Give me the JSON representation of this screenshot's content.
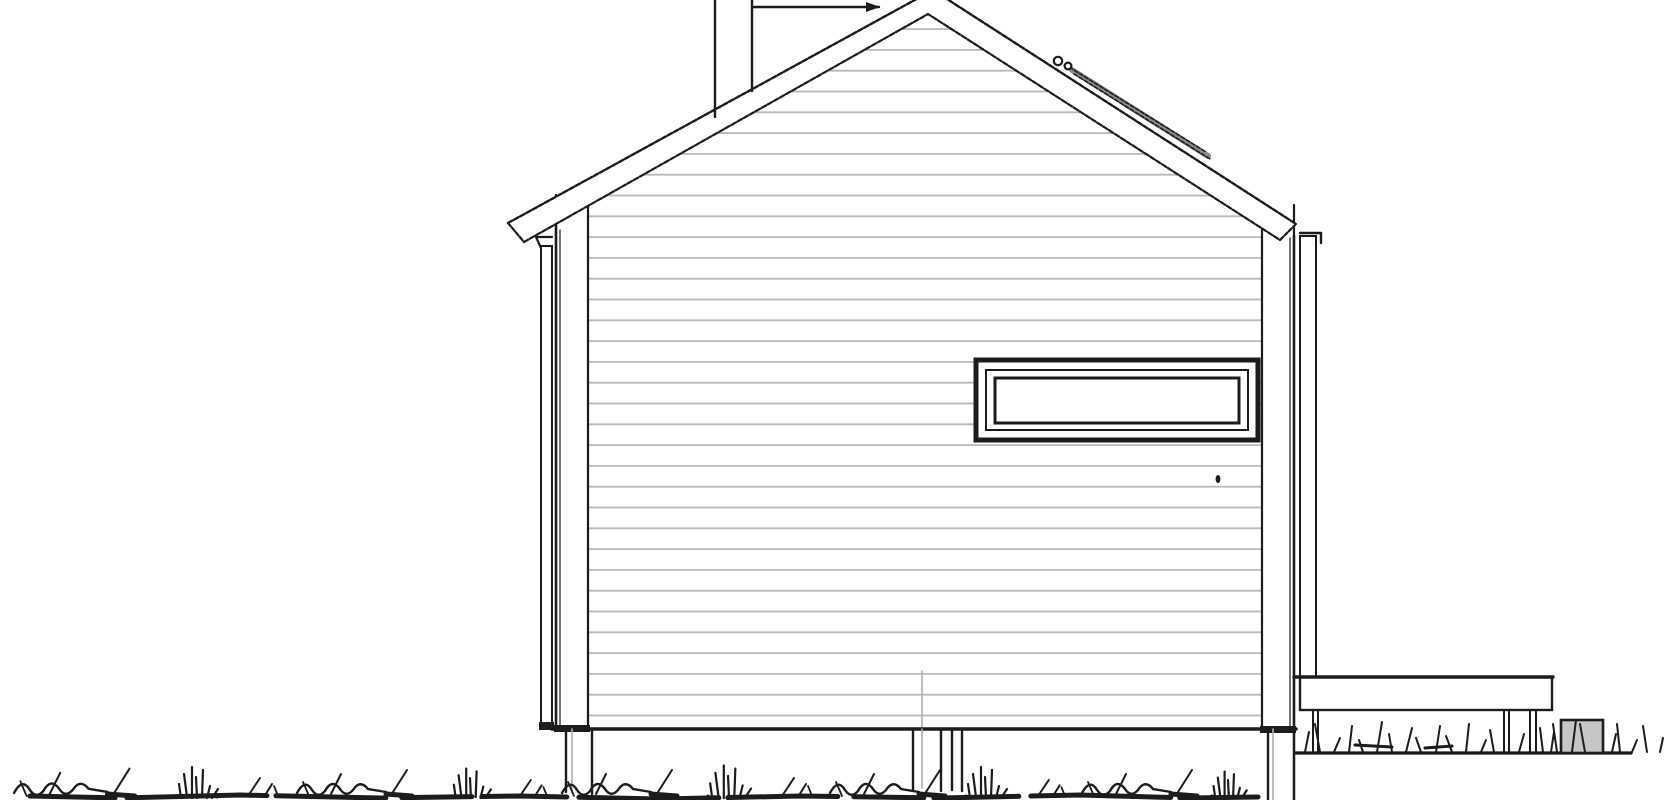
{
  "canvas": {
    "width": 1670,
    "height": 800,
    "background": "#ffffff"
  },
  "palette": {
    "ink": "#1c1c1c",
    "siding_line": "#b9b9b9",
    "faint_line": "#adadad",
    "accessory_gray": "#8a8a8a",
    "utility_fill": "#c6c6c6",
    "paper": "#ffffff"
  },
  "elevation": {
    "roof": {
      "band": [
        [
          508,
          223
        ],
        [
          933,
          -10
        ],
        [
          1296,
          224
        ],
        [
          1280,
          240
        ],
        [
          928,
          14
        ],
        [
          524,
          242
        ]
      ],
      "outer": [
        [
          508,
          223
        ],
        [
          933,
          -10
        ],
        [
          1296,
          224
        ]
      ],
      "inner": [
        [
          524,
          242
        ],
        [
          928,
          14
        ],
        [
          1280,
          240
        ]
      ],
      "caps": [
        [
          [
            508,
            223
          ],
          [
            524,
            242
          ]
        ],
        [
          [
            1296,
            224
          ],
          [
            1280,
            240
          ]
        ]
      ],
      "accessory": {
        "x1": 1072,
        "y1": 70,
        "x2": 1208,
        "y2": 156,
        "rings": [
          [
            1058,
            61,
            4.2
          ],
          [
            1068,
            66,
            3.4
          ]
        ]
      }
    },
    "chimney": {
      "lines": [
        [
          715,
          0,
          715,
          117
        ],
        [
          752,
          0,
          752,
          91
        ],
        [
          753,
          7,
          879,
          7
        ]
      ],
      "arrow": [
        [
          866,
          2
        ],
        [
          880,
          7
        ],
        [
          866,
          12
        ]
      ]
    },
    "facade": {
      "outline": [
        [
          556,
          224
        ],
        [
          928,
          14
        ],
        [
          1294,
          238
        ],
        [
          1294,
          729
        ],
        [
          556,
          729
        ]
      ],
      "left_edge": [
        556,
        226,
        556,
        729
      ],
      "right_edge": [
        1294,
        236,
        1294,
        800
      ],
      "edge_double_lines": [
        [
          560,
          230,
          560,
          728
        ],
        [
          1290,
          238,
          1290,
          728
        ]
      ],
      "bottom_line": [
        552,
        729,
        1296,
        729
      ],
      "siding_clip": [
        [
          588,
          206
        ],
        [
          928,
          14
        ],
        [
          1262,
          214
        ],
        [
          1262,
          729
        ],
        [
          588,
          729
        ]
      ],
      "siding": {
        "x1": 588,
        "x2": 1262,
        "bottom": 715.5,
        "spacing": 20.8,
        "count": 34
      },
      "corner_trims": [
        {
          "x": 556,
          "w": 32,
          "top": 195
        },
        {
          "x": 1262,
          "w": 32,
          "top": 205
        }
      ],
      "trim_caps": [
        [
          554,
          725,
          36,
          7
        ],
        [
          1260,
          726,
          36,
          7
        ]
      ],
      "center_joint": {
        "x": 922,
        "y1": 671,
        "y2": 729
      },
      "handle_dot": {
        "x": 1218,
        "y": 479
      }
    },
    "window": {
      "outer": [
        976,
        360,
        282,
        80
      ],
      "mid": [
        986,
        370,
        262,
        60
      ],
      "glass": [
        995,
        378,
        244,
        45
      ]
    },
    "downspouts": {
      "left": {
        "rect": [
          541,
          246,
          11,
          481
        ],
        "cap": [
          539,
          722,
          15,
          8
        ],
        "hook": [
          [
            552,
            237
          ],
          [
            536,
            237
          ],
          [
            541,
            248
          ]
        ]
      },
      "right": {
        "rect": [
          1300,
          236,
          16,
          441
        ],
        "hook": [
          [
            1300,
            233
          ],
          [
            1321,
            233
          ],
          [
            1321,
            243
          ]
        ]
      }
    },
    "foundation": {
      "posts": [
        {
          "black": [
            [
              566,
              729,
              566,
              792
            ],
            [
              592,
              729,
              592,
              794
            ]
          ],
          "gray": [
            [
              572,
              729,
              572,
              790
            ]
          ]
        },
        {
          "black": [
            [
              913,
              729,
              913,
              790
            ],
            [
              941,
              729,
              941,
              791
            ],
            [
              952,
              729,
              952,
              790
            ],
            [
              962,
              729,
              962,
              791
            ]
          ],
          "gray": [
            [
              922,
              729,
              922,
              788
            ]
          ]
        },
        {
          "black": [
            [
              1268,
              729,
              1268,
              800
            ]
          ],
          "gray": [
            [
              1273,
              729,
              1273,
              800
            ]
          ]
        }
      ]
    },
    "deck": {
      "rect": [
        1300,
        677,
        252,
        33
      ],
      "top_line": [
        1294,
        677,
        1553,
        677
      ],
      "posts": [
        [
          1313,
          711,
          1313,
          752
        ],
        [
          1318,
          711,
          1318,
          752
        ],
        [
          1504,
          711,
          1504,
          752
        ],
        [
          1509,
          711,
          1509,
          752
        ],
        [
          1530,
          711,
          1530,
          752
        ],
        [
          1536,
          711,
          1536,
          752
        ]
      ],
      "ground_line": [
        1296,
        753,
        1631,
        753
      ]
    },
    "utility_box": {
      "rect": [
        1561,
        720,
        42,
        33
      ]
    },
    "grass": {
      "main_row_y": 798,
      "baseline": {
        "path": [
          [
            30,
            796
          ],
          [
            120,
            798
          ],
          [
            240,
            795
          ],
          [
            380,
            798
          ],
          [
            520,
            796
          ],
          [
            660,
            799
          ],
          [
            800,
            796
          ],
          [
            940,
            798
          ],
          [
            1080,
            795
          ],
          [
            1190,
            798
          ],
          [
            1258,
            797
          ]
        ],
        "width": 5,
        "dash": "85 12 140 9 110 16 70 10"
      },
      "clusters": [
        {
          "t": "s",
          "x": 14,
          "s": 1.05
        },
        {
          "t": "t",
          "x": 196,
          "s": 1.0
        },
        {
          "t": "d",
          "x": 248,
          "s": 1.0
        },
        {
          "t": "s",
          "x": 297,
          "s": 1.0
        },
        {
          "t": "t",
          "x": 470,
          "s": 0.95
        },
        {
          "t": "d",
          "x": 520,
          "s": 0.9
        },
        {
          "t": "s",
          "x": 562,
          "s": 1.0
        },
        {
          "t": "t",
          "x": 728,
          "s": 1.05
        },
        {
          "t": "d",
          "x": 782,
          "s": 1.0
        },
        {
          "t": "s",
          "x": 830,
          "s": 1.0
        },
        {
          "t": "t",
          "x": 985,
          "s": 1.0
        },
        {
          "t": "d",
          "x": 1038,
          "s": 0.9
        },
        {
          "t": "s",
          "x": 1082,
          "s": 1.0
        },
        {
          "t": "t",
          "x": 1228,
          "s": 0.85
        }
      ],
      "under_deck": {
        "base_y": 752,
        "blades": [
          [
            1305,
            20,
            4
          ],
          [
            1320,
            28,
            -5
          ],
          [
            1334,
            14,
            6
          ],
          [
            1349,
            26,
            3
          ],
          [
            1363,
            12,
            -4
          ],
          [
            1377,
            30,
            5
          ],
          [
            1392,
            18,
            -3
          ],
          [
            1406,
            24,
            6
          ],
          [
            1421,
            14,
            -5
          ],
          [
            1436,
            26,
            4
          ],
          [
            1452,
            16,
            -6
          ],
          [
            1466,
            28,
            3
          ],
          [
            1481,
            12,
            5
          ],
          [
            1494,
            22,
            -4
          ],
          [
            1519,
            18,
            5
          ],
          [
            1543,
            24,
            -3
          ]
        ],
        "squiggles": [
          [
            1355,
            745,
            1392,
            747
          ],
          [
            1425,
            748,
            1452,
            746
          ]
        ]
      },
      "right_blades": [
        [
          1551,
          20,
          3
        ],
        [
          1557,
          28,
          -4
        ],
        [
          1572,
          32,
          4
        ],
        [
          1585,
          28,
          -5
        ],
        [
          1612,
          18,
          4
        ],
        [
          1620,
          28,
          -3
        ],
        [
          1632,
          12,
          5
        ],
        [
          1647,
          26,
          -4
        ],
        [
          1660,
          14,
          3
        ]
      ]
    }
  }
}
